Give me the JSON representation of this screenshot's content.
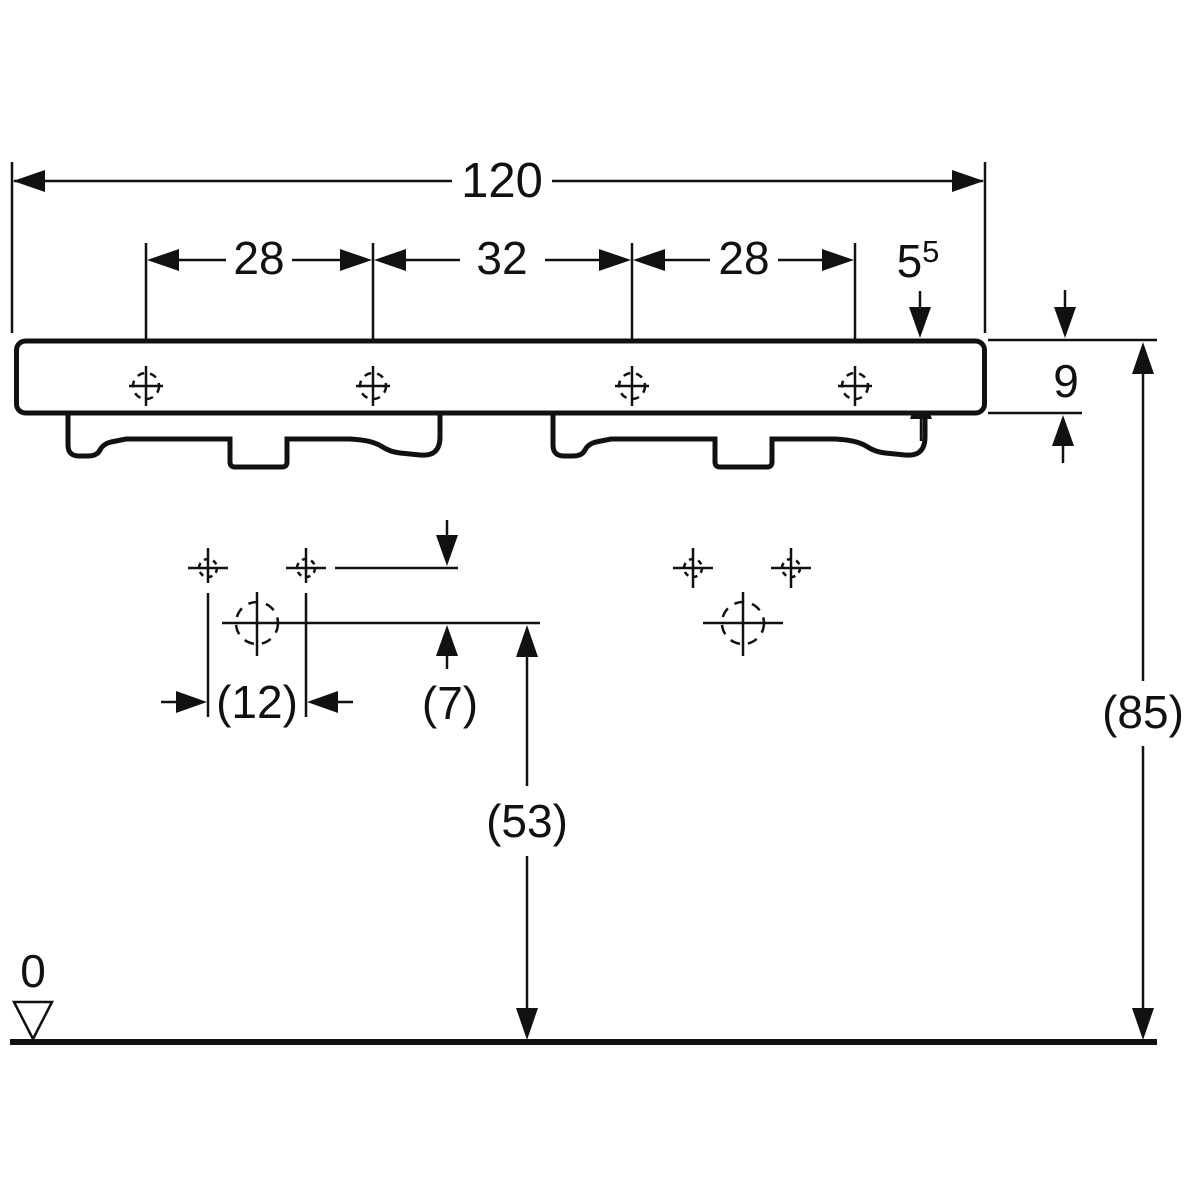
{
  "colors": {
    "line": "#111111",
    "background": "#ffffff"
  },
  "labels": {
    "overall_width": "120",
    "spacing_left": "28",
    "spacing_center": "32",
    "spacing_right": "28",
    "tap_edge_distance_base": "5",
    "tap_edge_distance_sup": "5",
    "apron_height": "9",
    "hole_spacing": "(12)",
    "hole_offset": "(7)",
    "drain_height": "(53)",
    "rim_height": "(85)",
    "datum_level": "0"
  }
}
